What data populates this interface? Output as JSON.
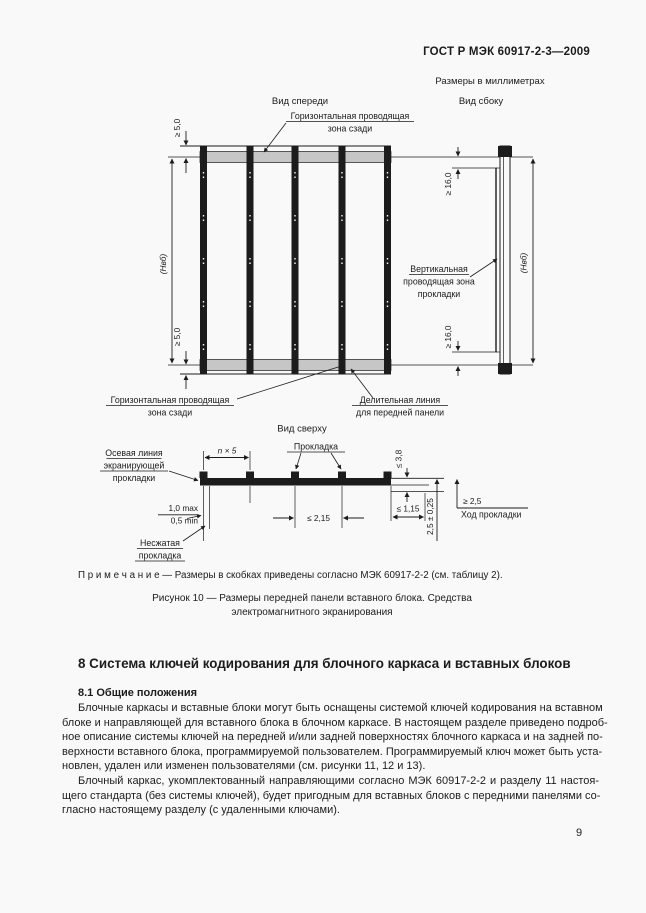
{
  "page": {
    "header": "ГОСТ Р МЭК 60917-2-3—2009",
    "units_note": "Размеры в миллиметрах",
    "page_number": "9"
  },
  "figure": {
    "front": {
      "title": "Вид спереди",
      "zone_top_l1": "Горизонтальная проводящая",
      "zone_top_l2": "зона сзади",
      "zone_bottom_l1": "Горизонтальная проводящая",
      "zone_bottom_l2": "зона сзади",
      "divline_l1": "Делительная линия",
      "divline_l2": "для передней панели",
      "dim_ge5": "≥ 5,0",
      "dim_h": "(Hвб)"
    },
    "side": {
      "title": "Вид сбоку",
      "vert_zone_l1": "Вертикальная",
      "vert_zone_l2": "проводящая зона",
      "vert_zone_l3": "прокладки",
      "dim_ge16": "≥ 16,0",
      "dim_h": "(Hвб)"
    },
    "top": {
      "title": "Вид сверху",
      "gasket_label": "Прокладка",
      "axis_l1": "Осевая линия",
      "axis_l2": "экранирующей",
      "axis_l3": "прокладки",
      "uncompressed_l1": "Несжатая",
      "uncompressed_l2": "прокладка",
      "dim_pitch": "n × 5",
      "dim_max": "1,0 max",
      "dim_min": "0,5 min",
      "dim_le215": "≤ 2,15",
      "dim_le115": "≤ 1,15",
      "dim_le38": "≤ 3,8",
      "dim_tol": "2,5 ± 0,25",
      "dim_ge25": "≥ 2,5",
      "travel_label": "Ход прокладки"
    },
    "note": "П р и м е ч а н и е — Размеры в скобках приведены согласно МЭК 60917-2-2 (см. таблицу 2).",
    "caption_l1": "Рисунок 10 — Размеры передней панели вставного блока. Средства",
    "caption_l2": "электромагнитного  экранирования"
  },
  "section": {
    "heading": "8 Система ключей кодирования для блочного каркаса и вставных блоков",
    "sub_heading": "8.1 Общие положения",
    "p1_lines": [
      "Блочные каркасы и вставные блоки могут быть оснащены системой ключей кодирования на вставном",
      "блоке и направляющей для вставного блока в блочном каркасе. В настоящем разделе приведено подроб-",
      "ное описание системы ключей на передней и/или задней поверхностях блочного каркаса и на задней по-",
      "верхности вставного блока, программируемой пользователем. Программируемый ключ может быть уста-",
      "новлен, удален или изменен пользователями (см. рисунки 11, 12 и 13)."
    ],
    "p2_lines": [
      "Блочный каркас, укомплектованный направляющими согласно МЭК 60917-2-2 и разделу 11 настоя-",
      "щего стандарта (без системы ключей), будет пригодным для вставных блоков с передними панелями со-",
      "гласно настоящему разделу (с удаленными ключами)."
    ]
  }
}
